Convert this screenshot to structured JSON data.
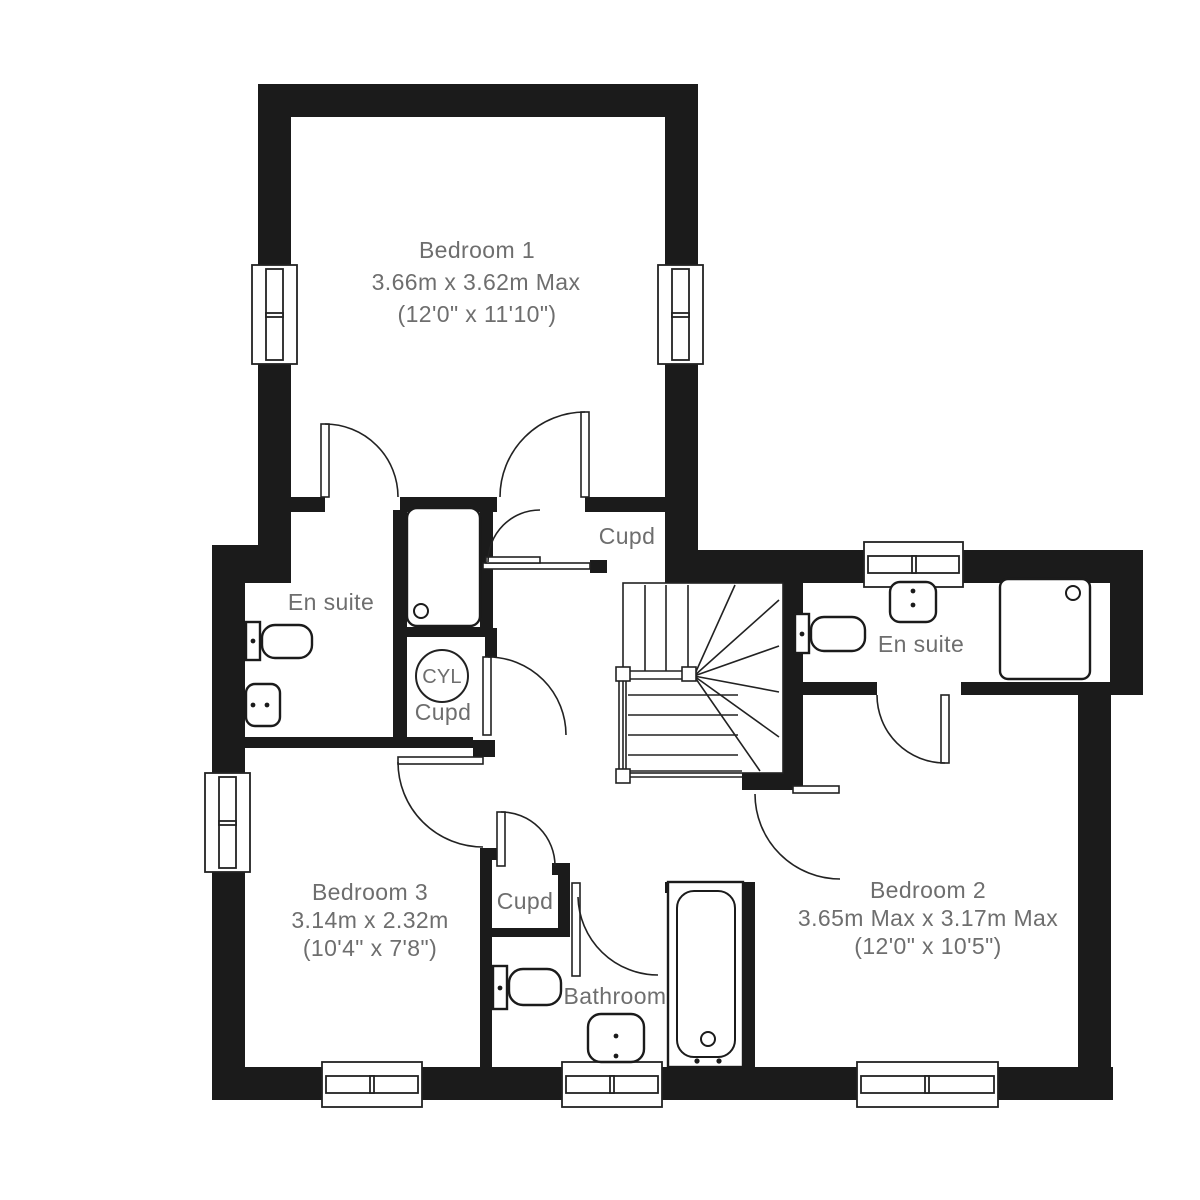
{
  "colors": {
    "wall": "#1b1b1b",
    "line": "#222222",
    "text": "#6e6e6e",
    "background": "#ffffff"
  },
  "rooms": {
    "bedroom1": {
      "name": "Bedroom 1",
      "metric": "3.66m x 3.62m Max",
      "imperial": "(12'0\" x 11'10\")"
    },
    "bedroom2": {
      "name": "Bedroom 2",
      "metric": "3.65m Max x 3.17m Max",
      "imperial": "(12'0\" x 10'5\")"
    },
    "bedroom3": {
      "name": "Bedroom 3",
      "metric": "3.14m x 2.32m",
      "imperial": "(10'4\" x 7'8\")"
    },
    "ensuite_left": {
      "name": "En suite"
    },
    "ensuite_right": {
      "name": "En suite"
    },
    "bathroom": {
      "name": "Bathroom"
    },
    "cupboard_landing": {
      "name": "Cupd"
    },
    "cupboard_cylinder": {
      "name": "Cupd",
      "tank": "CYL"
    },
    "cupboard_hall": {
      "name": "Cupd"
    }
  }
}
